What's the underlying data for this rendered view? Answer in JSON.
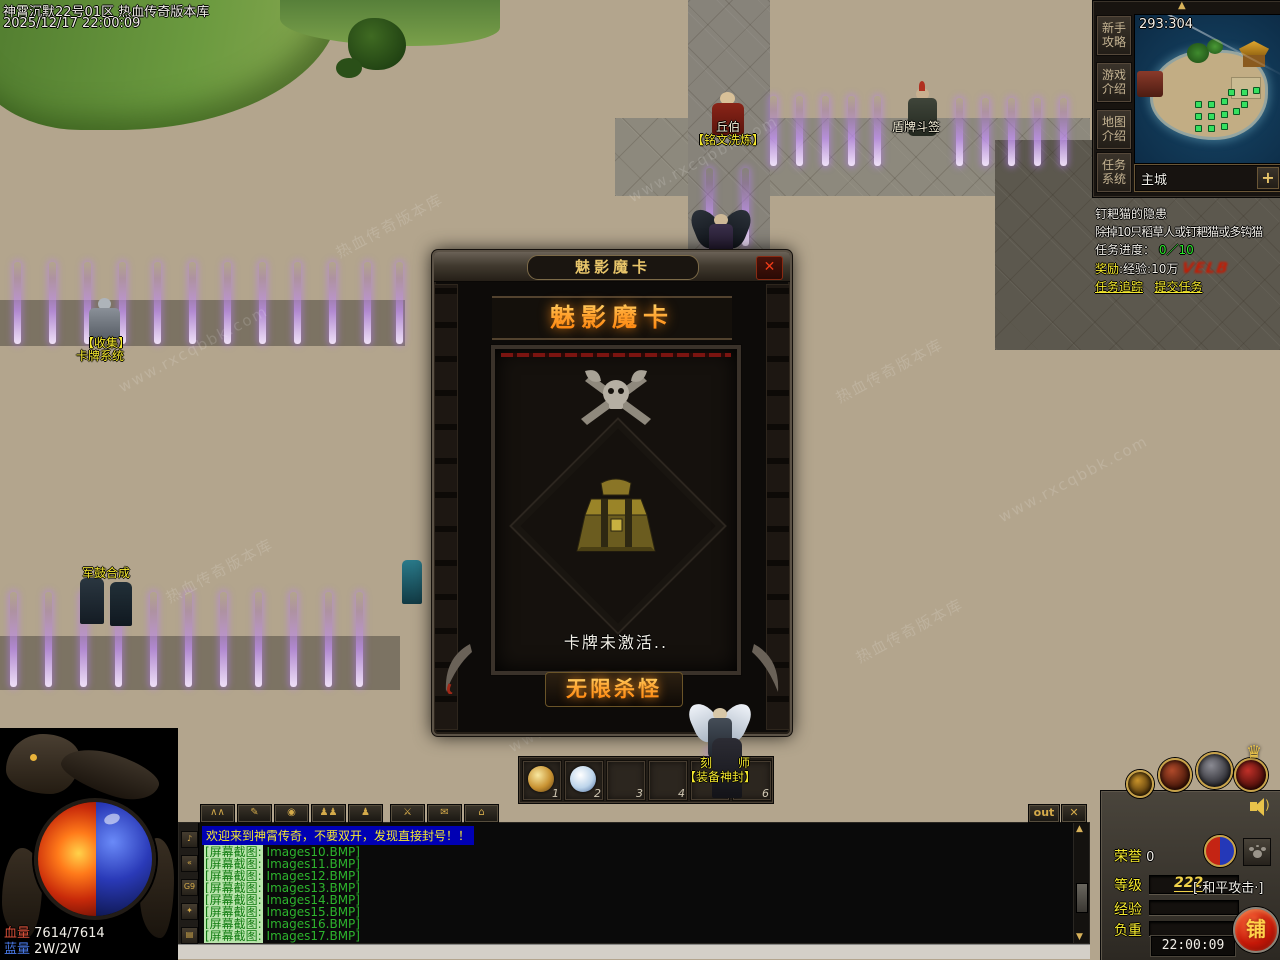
{
  "hud": {
    "server_name": "神霄沉默22号01区 热血传奇版本库",
    "datetime": "2025/12/17 22:00:09"
  },
  "watermark": {
    "site": "www.rxcqbbk.com",
    "name": "热血传奇版本库"
  },
  "minimap": {
    "coords": "293:304",
    "location": "主城",
    "zoom_button": "+",
    "collapse_icon": "▲",
    "nav_buttons": [
      {
        "label": "新手\n攻略"
      },
      {
        "label": "游戏\n介绍"
      },
      {
        "label": "地图\n介绍"
      },
      {
        "label": "任务\n系统"
      }
    ]
  },
  "quest": {
    "title": "钉耙猫的隐患",
    "desc": "除掉10只稻草人或钉耙猫或多钩猫",
    "progress_label": "任务进度：",
    "progress_value": "0／10",
    "reward_label": "奖励",
    "reward_text": ":经验:10万",
    "reward_stamp": "VELB",
    "links": [
      {
        "label": "任务追踪"
      },
      {
        "label": "提交任务"
      }
    ]
  },
  "dialog": {
    "title": "魅影魔卡",
    "header": "魅影魔卡",
    "status_text": "卡牌未激活..",
    "action_button": "无限杀怪",
    "close_label": "✕"
  },
  "npcs": {
    "qiubo_name": "丘伯",
    "qiubo_title": "【铭文洗炼】",
    "shield_name": "盾牌斗签",
    "collect_title": "【收集】",
    "collect_name": "卡牌系统",
    "drum_name": "军鼓合成",
    "seal_line1": "刻师",
    "seal_line2": "【装备神封】"
  },
  "quickbar": {
    "slot_numbers": [
      "1",
      "2",
      "3",
      "4",
      "5",
      "6"
    ]
  },
  "chat_toolbar": {
    "out_label": "out",
    "close_label": "✕",
    "icons": [
      {
        "glyph": "∧∧"
      },
      {
        "glyph": "✎"
      },
      {
        "glyph": "◉"
      },
      {
        "glyph": "♟♟"
      },
      {
        "glyph": "♟"
      },
      {
        "glyph": "⚔"
      },
      {
        "glyph": "✉"
      },
      {
        "glyph": "⌂"
      }
    ]
  },
  "chat": {
    "system_message": "欢迎来到神霄传奇，不要双开，发现直接封号！！",
    "scroll_up_icon": "▲",
    "scroll_down_icon": "▼",
    "side_icons": [
      {
        "glyph": "♪"
      },
      {
        "glyph": "«"
      },
      {
        "glyph": "G9"
      },
      {
        "glyph": "✦"
      },
      {
        "glyph": "▤"
      }
    ],
    "lines": [
      {
        "label": "[屏幕截图:",
        "file": " Images10.BMP]"
      },
      {
        "label": "[屏幕截图:",
        "file": " Images11.BMP]"
      },
      {
        "label": "[屏幕截图:",
        "file": " Images12.BMP]"
      },
      {
        "label": "[屏幕截图:",
        "file": " Images13.BMP]"
      },
      {
        "label": "[屏幕截图:",
        "file": " Images14.BMP]"
      },
      {
        "label": "[屏幕截图:",
        "file": " Images15.BMP]"
      },
      {
        "label": "[屏幕截图:",
        "file": " Images16.BMP]"
      },
      {
        "label": "[屏幕截图:",
        "file": " Images17.BMP]"
      }
    ]
  },
  "status_bars": {
    "hp_label": "血量",
    "hp_value": "7614/7614",
    "mp_label": "蓝量",
    "mp_value": "2W/2W"
  },
  "char_panel": {
    "honor_label": "荣誉",
    "honor_value": "0",
    "level_label": "等级",
    "level_value": "222",
    "attack_mode": "[·和平攻击·]",
    "exp_label": "经验",
    "weight_label": "负重",
    "clock": "22:00:09",
    "stall_button": "铺"
  }
}
